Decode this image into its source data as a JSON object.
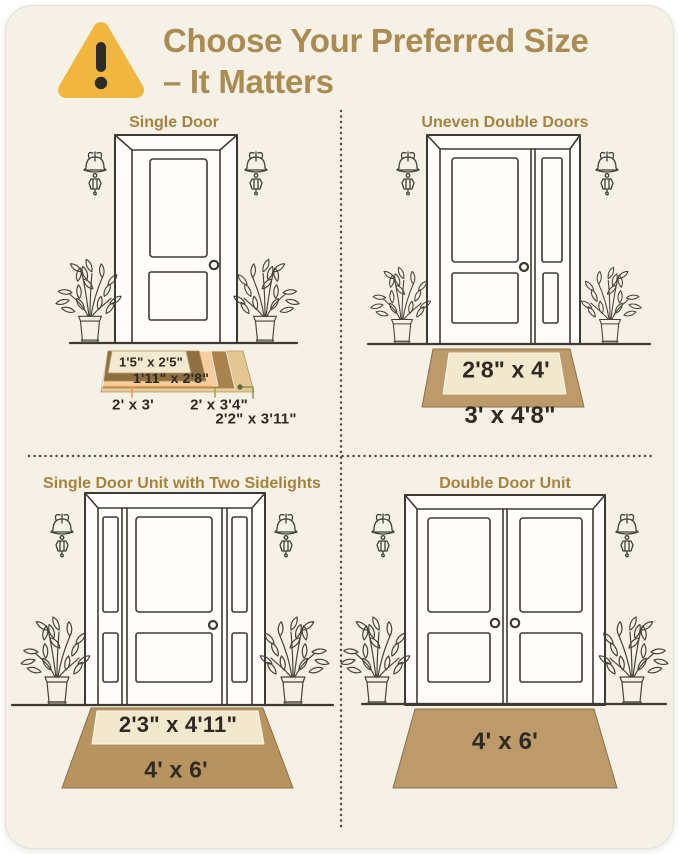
{
  "header": {
    "icon": "warning-triangle",
    "title_line1": "Choose Your Preferred Size",
    "title_line2": "– It Matters"
  },
  "colors": {
    "card_background": "#f6f1e7",
    "title_gold": "#aa8b51",
    "section_title_gold": "#a5833e",
    "warning_yellow": "#f1b640",
    "warning_glyph": "#2e2b26",
    "line_art": "#3e3a33",
    "label_text": "#2e2922",
    "mat_tan": "#bd9a6a",
    "mat_cream": "#f2e8cd",
    "mat_dark_brown": "#8d6f42",
    "mat_peach": "#f6cd9e",
    "mat_medium_brown": "#a9834e",
    "mat_light_tan": "#e3c691",
    "leader_orange": "#ec9f55",
    "leader_gold": "#c8a83b",
    "leader_khaki": "#8f8f52",
    "leader_dot_green": "#5c6b33"
  },
  "quadrants": {
    "single_door": {
      "title": "Single Door",
      "mat_sizes": [
        "1'5\" x 2'5\"",
        "1'11\" x 2'8\"",
        "2' x 3'",
        "2' x 3'4\"",
        "2'2\" x 3'11\""
      ]
    },
    "uneven_double_doors": {
      "title": "Uneven Double Doors",
      "inner_mat_size": "2'8\" x 4'",
      "outer_mat_size": "3' x 4'8\""
    },
    "single_door_sidelights": {
      "title": "Single Door Unit with Two Sidelights",
      "inner_mat_size": "2'3\" x 4'11\"",
      "outer_mat_size": "4' x 6'"
    },
    "double_door": {
      "title": "Double Door Unit",
      "mat_size": "4' x 6'"
    }
  }
}
